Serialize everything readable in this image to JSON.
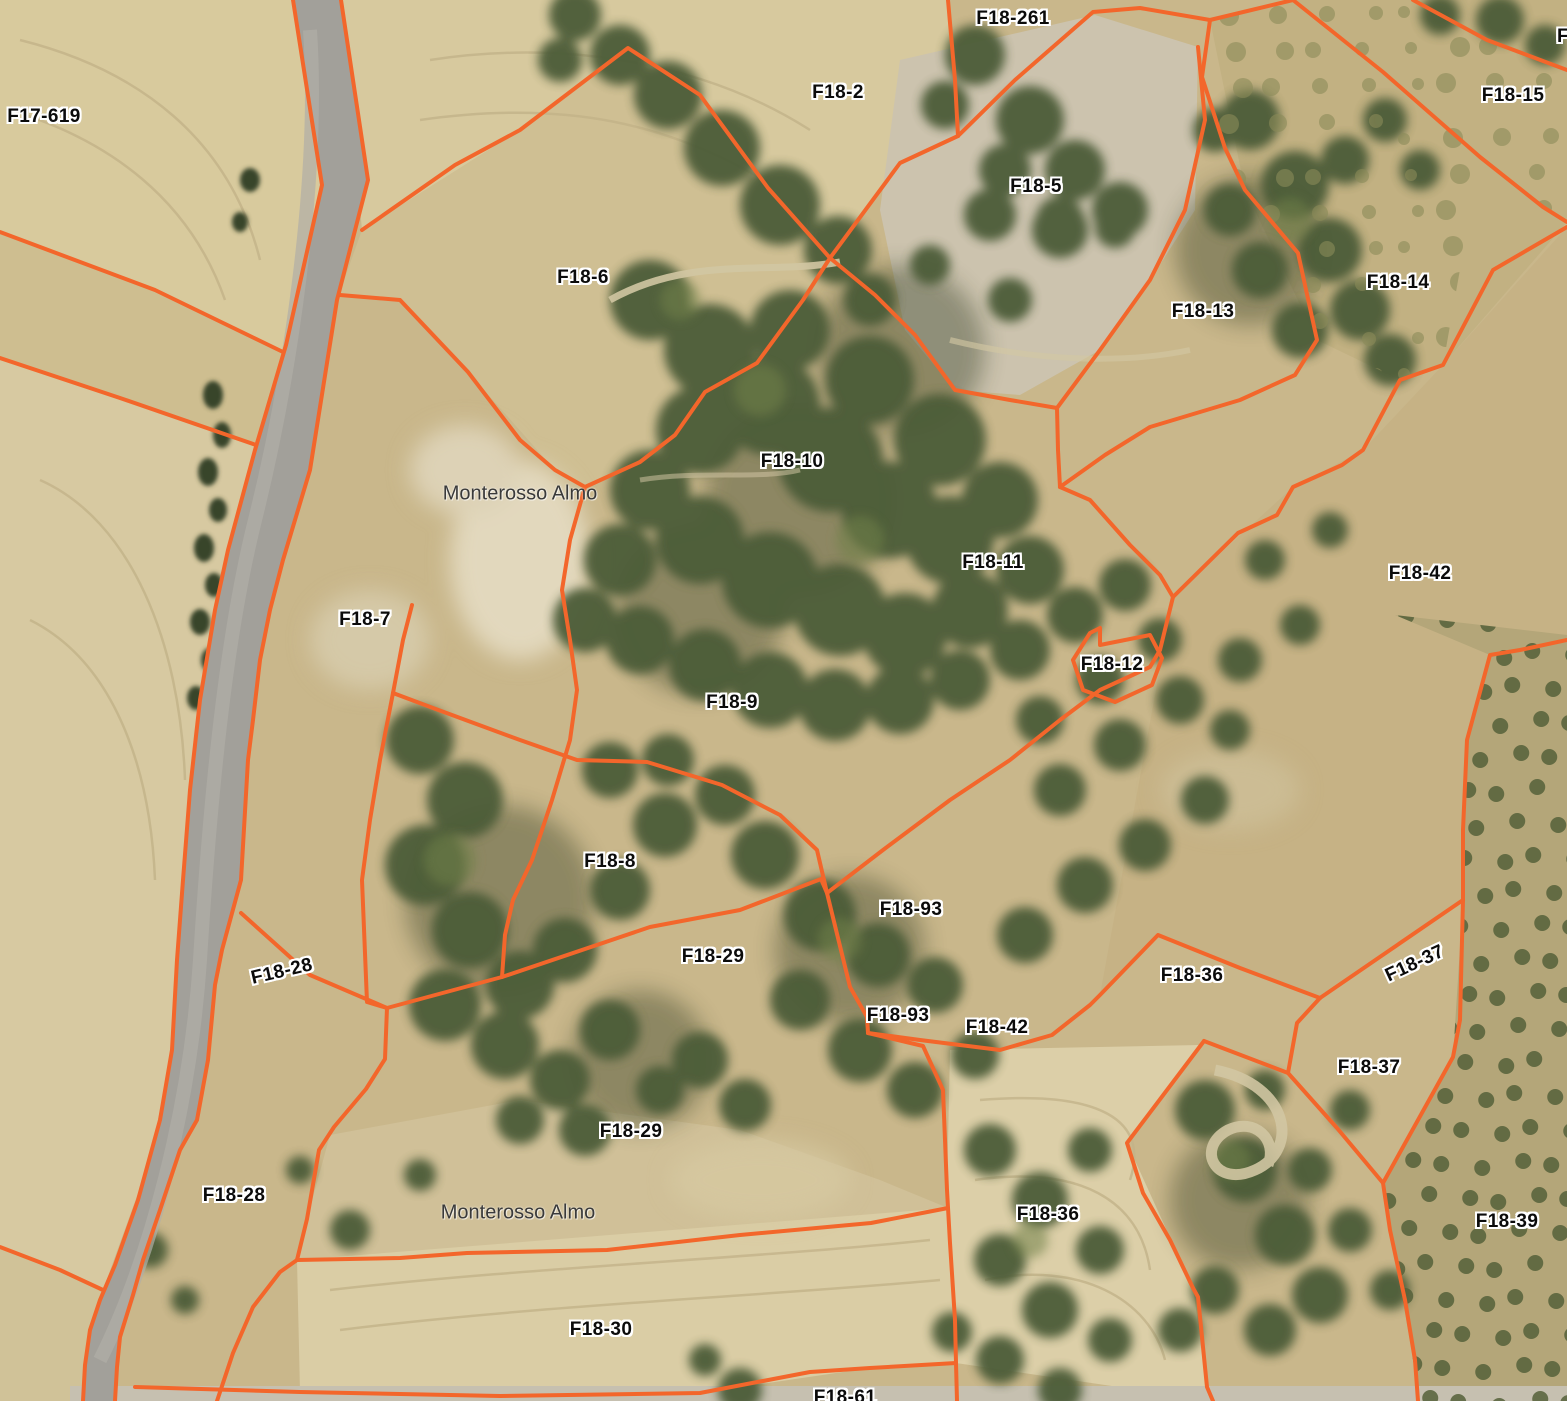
{
  "map": {
    "description": "Aerial orthophoto with cadastral parcel overlay",
    "boundary_color": "#f3662b",
    "parcel_label_color": "#0b0b0b",
    "place_label_color": "#3a3a3a",
    "labels": [
      {
        "text": "F17-619",
        "x": 44,
        "y": 117,
        "type": "parcel",
        "rot": 0
      },
      {
        "text": "F18-261",
        "x": 1013,
        "y": 19,
        "type": "parcel",
        "rot": 0
      },
      {
        "text": "F18-2",
        "x": 838,
        "y": 93,
        "type": "parcel",
        "rot": 0
      },
      {
        "text": "F",
        "x": 1563,
        "y": 37,
        "type": "parcel",
        "rot": 0
      },
      {
        "text": "F18-15",
        "x": 1513,
        "y": 96,
        "type": "parcel",
        "rot": 0
      },
      {
        "text": "F18-5",
        "x": 1036,
        "y": 187,
        "type": "parcel",
        "rot": 0
      },
      {
        "text": "F18-6",
        "x": 583,
        "y": 278,
        "type": "parcel",
        "rot": 0
      },
      {
        "text": "F18-14",
        "x": 1398,
        "y": 283,
        "type": "parcel",
        "rot": 0
      },
      {
        "text": "F18-13",
        "x": 1203,
        "y": 312,
        "type": "parcel",
        "rot": 0
      },
      {
        "text": "F18-10",
        "x": 792,
        "y": 462,
        "type": "parcel",
        "rot": 0
      },
      {
        "text": "Monterosso Almo",
        "x": 520,
        "y": 494,
        "type": "place",
        "rot": 0
      },
      {
        "text": "F18-11",
        "x": 993,
        "y": 563,
        "type": "parcel",
        "rot": 0
      },
      {
        "text": "F18-42",
        "x": 1420,
        "y": 574,
        "type": "parcel",
        "rot": 0
      },
      {
        "text": "F18-7",
        "x": 365,
        "y": 620,
        "type": "parcel",
        "rot": 0
      },
      {
        "text": "F18-12",
        "x": 1112,
        "y": 665,
        "type": "parcel",
        "rot": 0
      },
      {
        "text": "F18-9",
        "x": 732,
        "y": 703,
        "type": "parcel",
        "rot": 0
      },
      {
        "text": "F18-8",
        "x": 610,
        "y": 862,
        "type": "parcel",
        "rot": 0
      },
      {
        "text": "F18-93",
        "x": 911,
        "y": 910,
        "type": "parcel",
        "rot": 0
      },
      {
        "text": "F18-29",
        "x": 713,
        "y": 957,
        "type": "parcel",
        "rot": 0
      },
      {
        "text": "F18-28",
        "x": 282,
        "y": 972,
        "type": "parcel",
        "rot": -13
      },
      {
        "text": "F18-36",
        "x": 1192,
        "y": 976,
        "type": "parcel",
        "rot": 0
      },
      {
        "text": "F18-37",
        "x": 1415,
        "y": 964,
        "type": "parcel",
        "rot": -25
      },
      {
        "text": "F18-93",
        "x": 898,
        "y": 1016,
        "type": "parcel",
        "rot": 0
      },
      {
        "text": "F18-42",
        "x": 997,
        "y": 1028,
        "type": "parcel",
        "rot": 0
      },
      {
        "text": "F18-37",
        "x": 1369,
        "y": 1068,
        "type": "parcel",
        "rot": 0
      },
      {
        "text": "F18-29",
        "x": 631,
        "y": 1132,
        "type": "parcel",
        "rot": 0
      },
      {
        "text": "F18-28",
        "x": 234,
        "y": 1196,
        "type": "parcel",
        "rot": 0
      },
      {
        "text": "F18-36",
        "x": 1048,
        "y": 1215,
        "type": "parcel",
        "rot": 0
      },
      {
        "text": "F18-39",
        "x": 1507,
        "y": 1222,
        "type": "parcel",
        "rot": 0
      },
      {
        "text": "Monterosso Almo",
        "x": 518,
        "y": 1213,
        "type": "place",
        "rot": 0
      },
      {
        "text": "F18-30",
        "x": 601,
        "y": 1330,
        "type": "parcel",
        "rot": 0
      },
      {
        "text": "F18-61",
        "x": 845,
        "y": 1398,
        "type": "parcel",
        "rot": 0
      }
    ],
    "boundaries": [
      "0,232 155,290 283,352",
      "0,358 120,398 256,445",
      "0,1247 60,1270 103,1290",
      "362,230 455,165 520,130 628,48 700,95 768,188 830,258 875,295 915,335 955,390 1010,400 1057,408",
      "585,487 640,462 675,435 705,392 757,363 803,300 830,258 900,163 958,136",
      "958,136 955,80 948,0",
      "958,136 1015,80 1093,12 1140,8 1210,20",
      "1210,20 1293,0",
      "1210,20 1202,77 1225,148 1245,190 1298,253 1317,340 1295,375 1240,400 1150,427 1105,455 1060,487",
      "1198,47 1205,120 1185,210 1150,280 1100,350 1057,408",
      "1057,408 1058,450 1060,487",
      "1060,487 1090,500 1130,545 1160,575 1173,597",
      "1173,597 1238,533 1277,515 1293,487 1342,465 1363,450 1400,380 1443,365 1493,270 1567,227",
      "1173,597 1160,650 1150,667 1100,690 1060,720 1010,760 950,800 883,850 827,893",
      "340,295 400,300 468,372 520,440 555,470 585,487",
      "585,487 570,540 562,590 570,640 577,690 570,740 552,800 532,860 513,900 505,935 502,977",
      "393,693 433,708 520,740 577,760 647,762 722,785 780,815 817,850 827,893",
      "393,693 403,640 412,605",
      "393,693 380,760 370,820 362,880 367,1002 387,1008",
      "241,913 310,975 387,1008 502,977 650,927 740,910 821,879 827,893",
      "387,1008 385,1059 366,1089 334,1127 319,1150 307,1219 297,1260",
      "297,1260 280,1272 253,1307 233,1353 217,1401",
      "297,1260 400,1258 467,1253 607,1250 740,1235 871,1223 948,1208",
      "827,893 850,987 867,1017 868,1033",
      "868,1033 923,1046 943,1090 945,1140 947,1190 950,1243 955,1320 956,1363",
      "956,1363 957,1401",
      "956,1363 870,1368 810,1372 700,1393 500,1396 300,1392 135,1387",
      "868,1033 920,1040 1000,1050 1052,1035 1090,1005 1100,995 1158,935 1240,968 1320,998",
      "1320,998 1297,1023 1288,1073 1337,1128 1383,1183",
      "1383,1183 1453,1057 1460,1020 1463,900",
      "1320,998 1390,950 1463,900",
      "1463,900 1463,830 1467,740 1490,655 1520,650 1567,640",
      "1204,1041 1288,1073",
      "1204,1041 1127,1143 1143,1193 1170,1240 1193,1288 1198,1297 1207,1387 1213,1401",
      "1383,1183 1390,1230 1405,1300 1415,1360 1418,1401",
      "1293,0 1343,40 1383,72 1480,157 1543,207 1567,222",
      "1413,0 1487,40 1567,70",
      "1073,660 1090,633 1100,628 1100,645 1150,635 1162,658 1152,685 1115,702 1083,690 1073,660",
      "293,0 322,185 286,345 255,450 228,550 215,610 200,700 190,790 183,880 177,960 172,1050 160,1120 138,1200 115,1265 100,1300 90,1330 85,1365 83,1401",
      "341,0 368,180 337,300 310,470 283,560 270,610 260,660 253,720 248,760 241,880 222,950 215,985 208,1060 197,1120 180,1150 160,1210 143,1260 133,1295 120,1337 117,1367 115,1401"
    ]
  }
}
